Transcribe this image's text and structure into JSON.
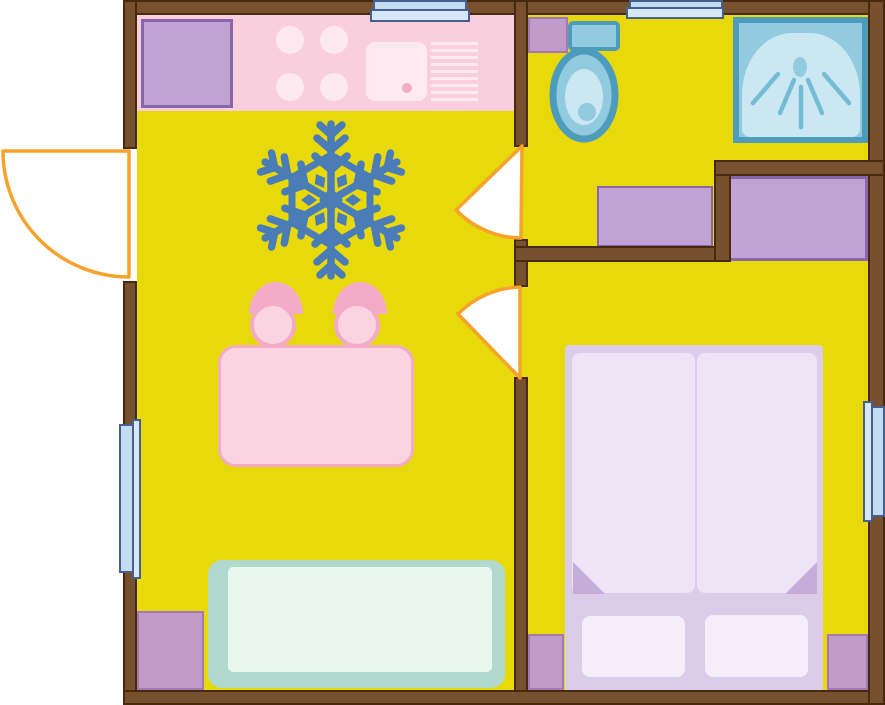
{
  "diagram_type": "apartment-floor-plan",
  "visible_text": [],
  "palette": {
    "floor": "#e8d90b",
    "wall": "#77502d",
    "wall-dark": "#49290e",
    "pink": "#f9cedd",
    "pink-light": "#fde9f0",
    "pink-light2": "#fbd4e2",
    "pink-mid": "#f3abc7",
    "purple": "#c0a3d2",
    "purple-dark": "#8766ab",
    "block": "#c09bc9",
    "block-dark": "#a478b1",
    "sofa": "#afdacd",
    "sofa-light": "#e9f7f1",
    "bed-base": "#dbcde9",
    "duvet": "#eee4f5",
    "fold": "#c5add9",
    "pillow": "#f5edf9",
    "fixture": "#92cbdf",
    "fixture-dark": "#4d9cbc",
    "fixture-light": "#cbe8f2",
    "spray": "#74bcd6",
    "win-pane": "#c4dcf0",
    "win-lip": "#d6e8f8",
    "win-border": "#475f8f",
    "door": "#f6a22d",
    "door-fill": "#ffffff",
    "snowflake": "#4a7cb8"
  },
  "rooms": [
    {
      "name": "living-kitchen",
      "items": [
        "kitchen-counter",
        "kitchen-cabinet",
        "stove-burners",
        "kitchen-sink",
        "vent-grate",
        "snowflake-ac-symbol",
        "dining-table",
        "chair",
        "chair",
        "sofa",
        "entry-door-swing",
        "window-left",
        "window-top-a",
        "corner-block"
      ]
    },
    {
      "name": "bathroom",
      "items": [
        "toilet",
        "shower-cabin",
        "bathroom-unit",
        "bathroom-door-swing",
        "window-top-b",
        "corner-block"
      ]
    },
    {
      "name": "bedroom",
      "items": [
        "double-bed",
        "duvet",
        "duvet",
        "pillow",
        "pillow",
        "wardrobe",
        "bedroom-door-swing",
        "window-right",
        "corner-block",
        "corner-block"
      ]
    }
  ],
  "icons": [
    "snowflake-icon",
    "door-swing-arc-icon",
    "shower-spray-icon",
    "toilet-icon",
    "window-symbol"
  ]
}
